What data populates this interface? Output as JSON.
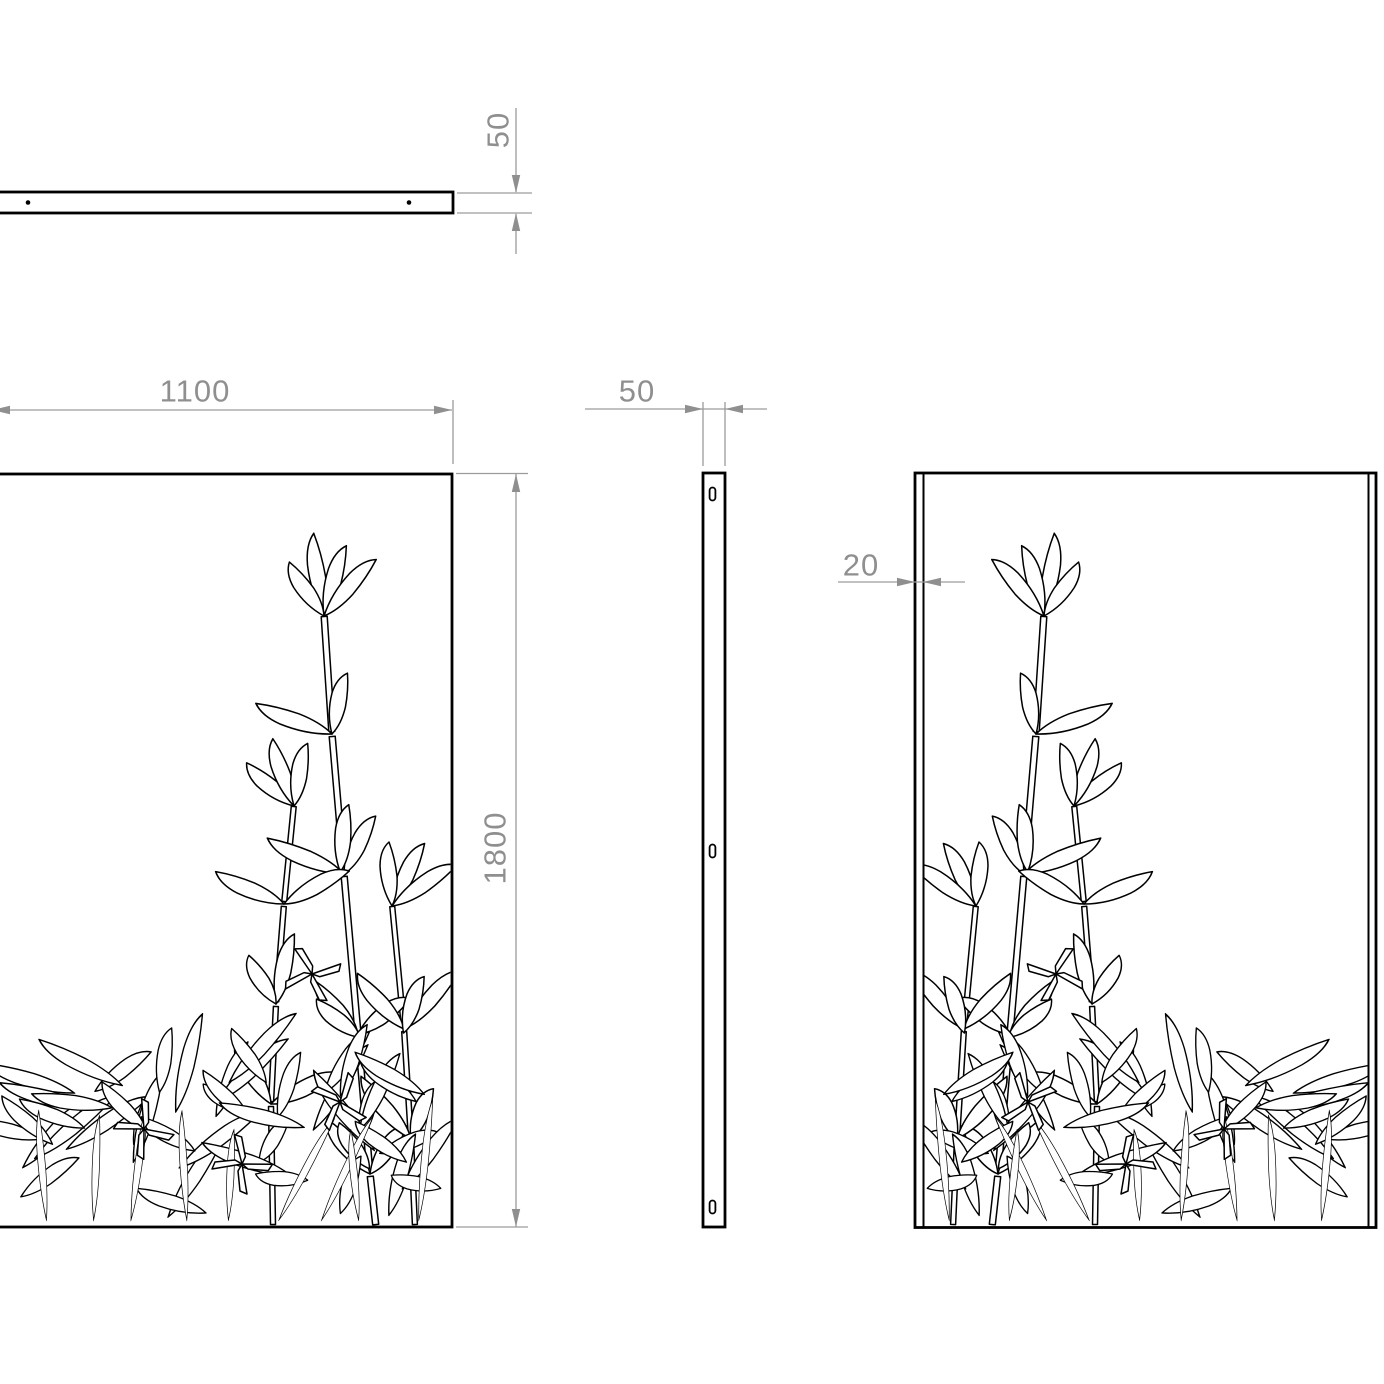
{
  "drawing": {
    "type": "orthographic-technical-drawing",
    "subject": "decorative bamboo laser-cut screen panel",
    "dimensions": {
      "top_thickness": {
        "label": "50"
      },
      "panel_width": {
        "label": "1100"
      },
      "panel_height": {
        "label": "1800"
      },
      "side_thickness": {
        "label": "50"
      },
      "flange_depth": {
        "label": "20"
      }
    },
    "colors": {
      "outline": "#000000",
      "dimension_line": "#9c9c9c",
      "dimension_text": "#8f8f8f",
      "background": "#ffffff"
    }
  }
}
